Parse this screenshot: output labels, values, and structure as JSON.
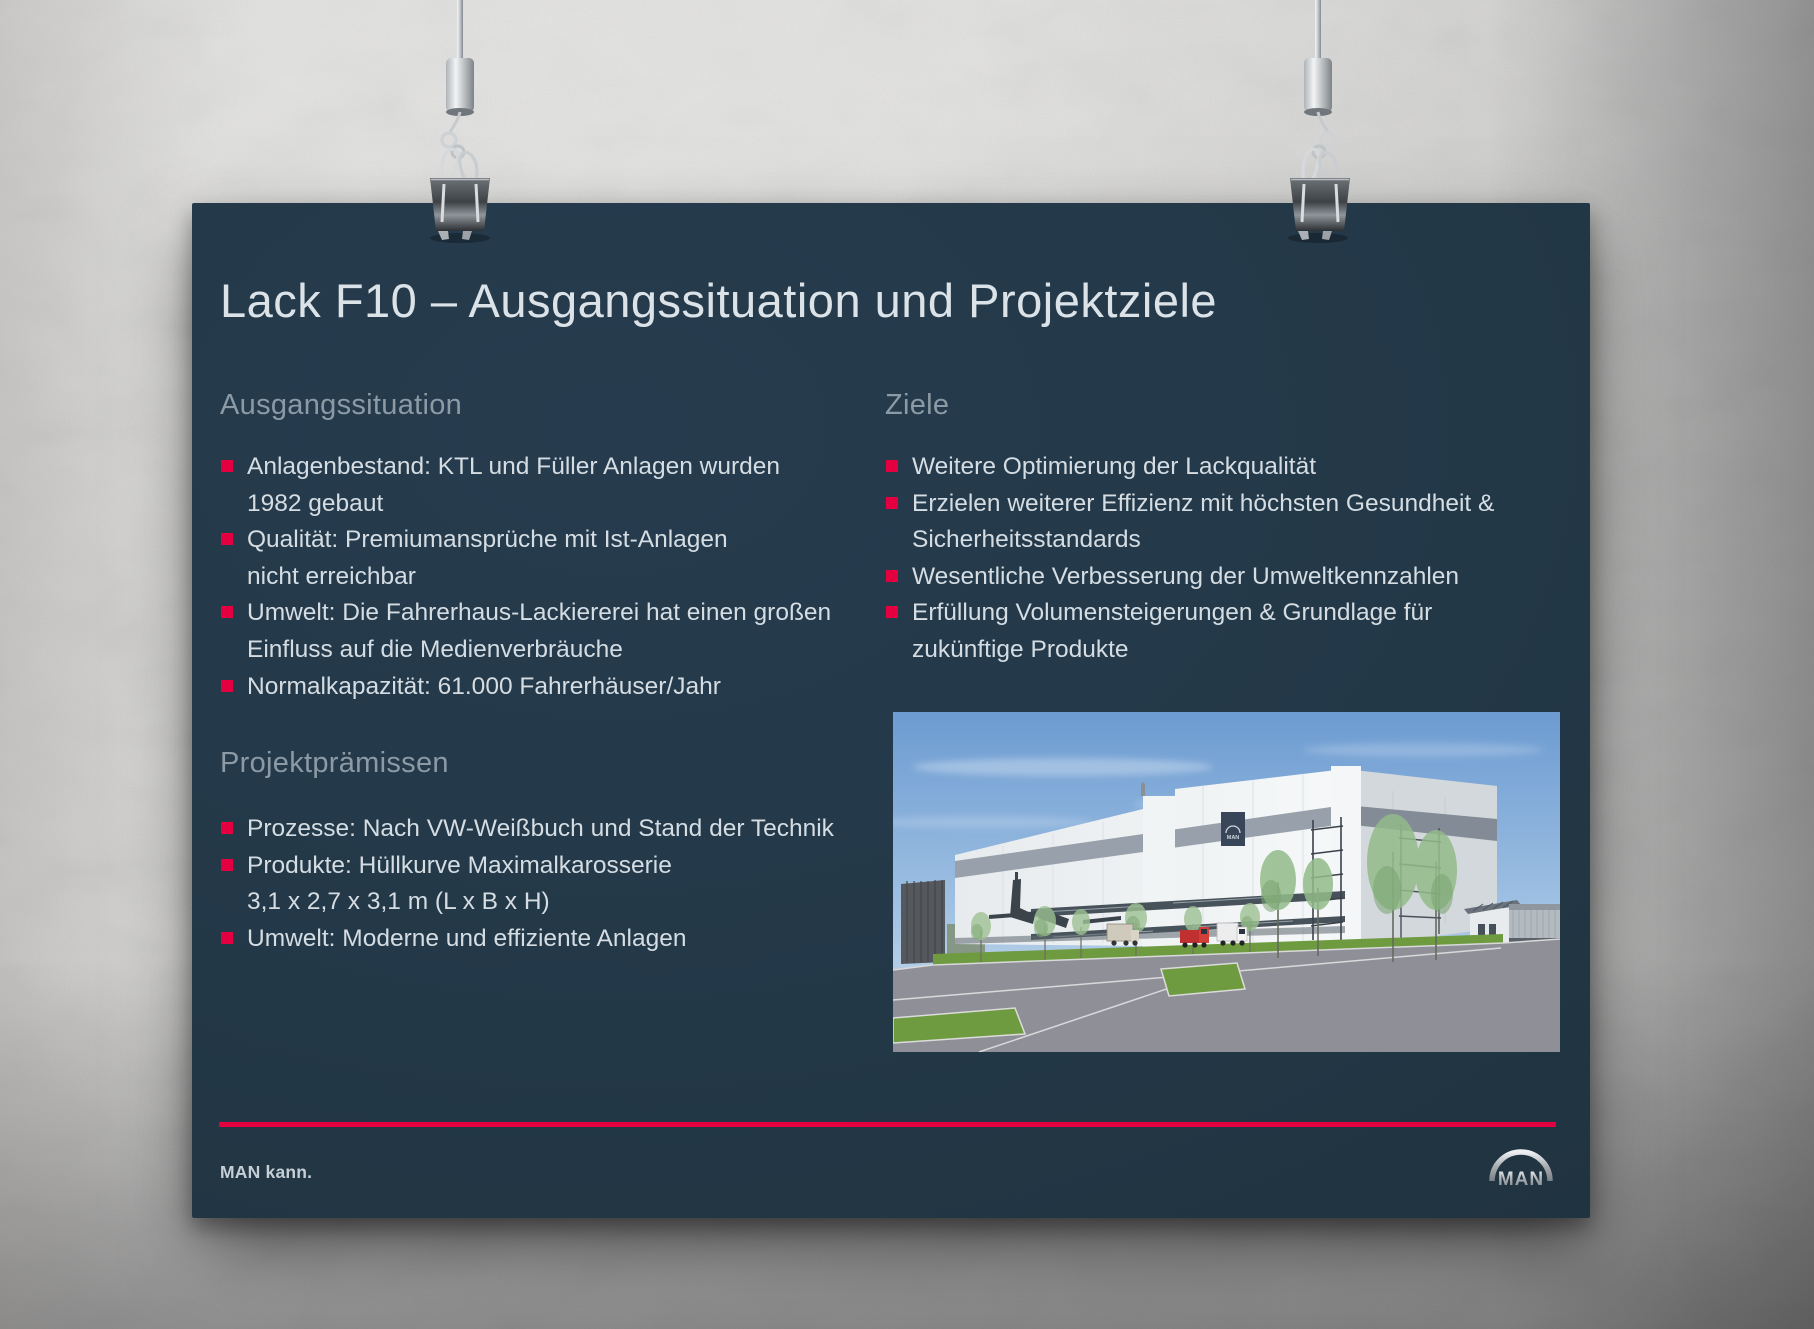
{
  "poster": {
    "title": "Lack F10 – Ausgangssituation und Projektziele",
    "left": {
      "s1": {
        "heading": "Ausgangssituation",
        "rows": [
          {
            "text": "Anlagenbestand: KTL und Füller Anlagen wurden",
            "bullet": true
          },
          {
            "text": "1982 gebaut",
            "bullet": false
          },
          {
            "text": "Qualität: Premiumansprüche mit Ist-Anlagen",
            "bullet": true
          },
          {
            "text": "nicht erreichbar",
            "bullet": false
          },
          {
            "text": "Umwelt: Die Fahrerhaus-Lackiererei hat einen großen",
            "bullet": true
          },
          {
            "text": "Einfluss auf die Medienverbräuche",
            "bullet": false
          },
          {
            "text": "Normalkapazität: 61.000 Fahrerhäuser/Jahr",
            "bullet": true
          }
        ]
      },
      "s2": {
        "heading": "Projektprämissen",
        "rows": [
          {
            "text": "Prozesse: Nach VW-Weißbuch und Stand der Technik",
            "bullet": true
          },
          {
            "text": "Produkte: Hüllkurve Maximalkarosserie",
            "bullet": true
          },
          {
            "text": "3,1 x 2,7 x 3,1 m (L x B x H)",
            "bullet": false
          },
          {
            "text": "Umwelt: Moderne und effiziente Anlagen",
            "bullet": true
          }
        ]
      }
    },
    "right": {
      "s1": {
        "heading": "Ziele",
        "rows": [
          {
            "text": "Weitere Optimierung der Lackqualität",
            "bullet": true
          },
          {
            "text": "Erzielen weiterer Effizienz mit höchsten Gesundheit &",
            "bullet": true
          },
          {
            "text": "Sicherheitsstandards",
            "bullet": false
          },
          {
            "text": "Wesentliche Verbesserung der Umweltkennzahlen",
            "bullet": true
          },
          {
            "text": "Erfüllung Volumensteigerungen & Grundlage für",
            "bullet": true
          },
          {
            "text": "zukünftige Produkte",
            "bullet": false
          }
        ]
      }
    },
    "footer": {
      "claim": "MAN kann.",
      "logo_text": "MAN"
    },
    "photo": {
      "building_logo": "MAN"
    },
    "colors": {
      "poster_background": "#233847",
      "accent_red": "#e40040",
      "heading_gray": "#8c9aa5",
      "body_text": "#d5dde3",
      "title_text": "#dce3e8"
    }
  }
}
